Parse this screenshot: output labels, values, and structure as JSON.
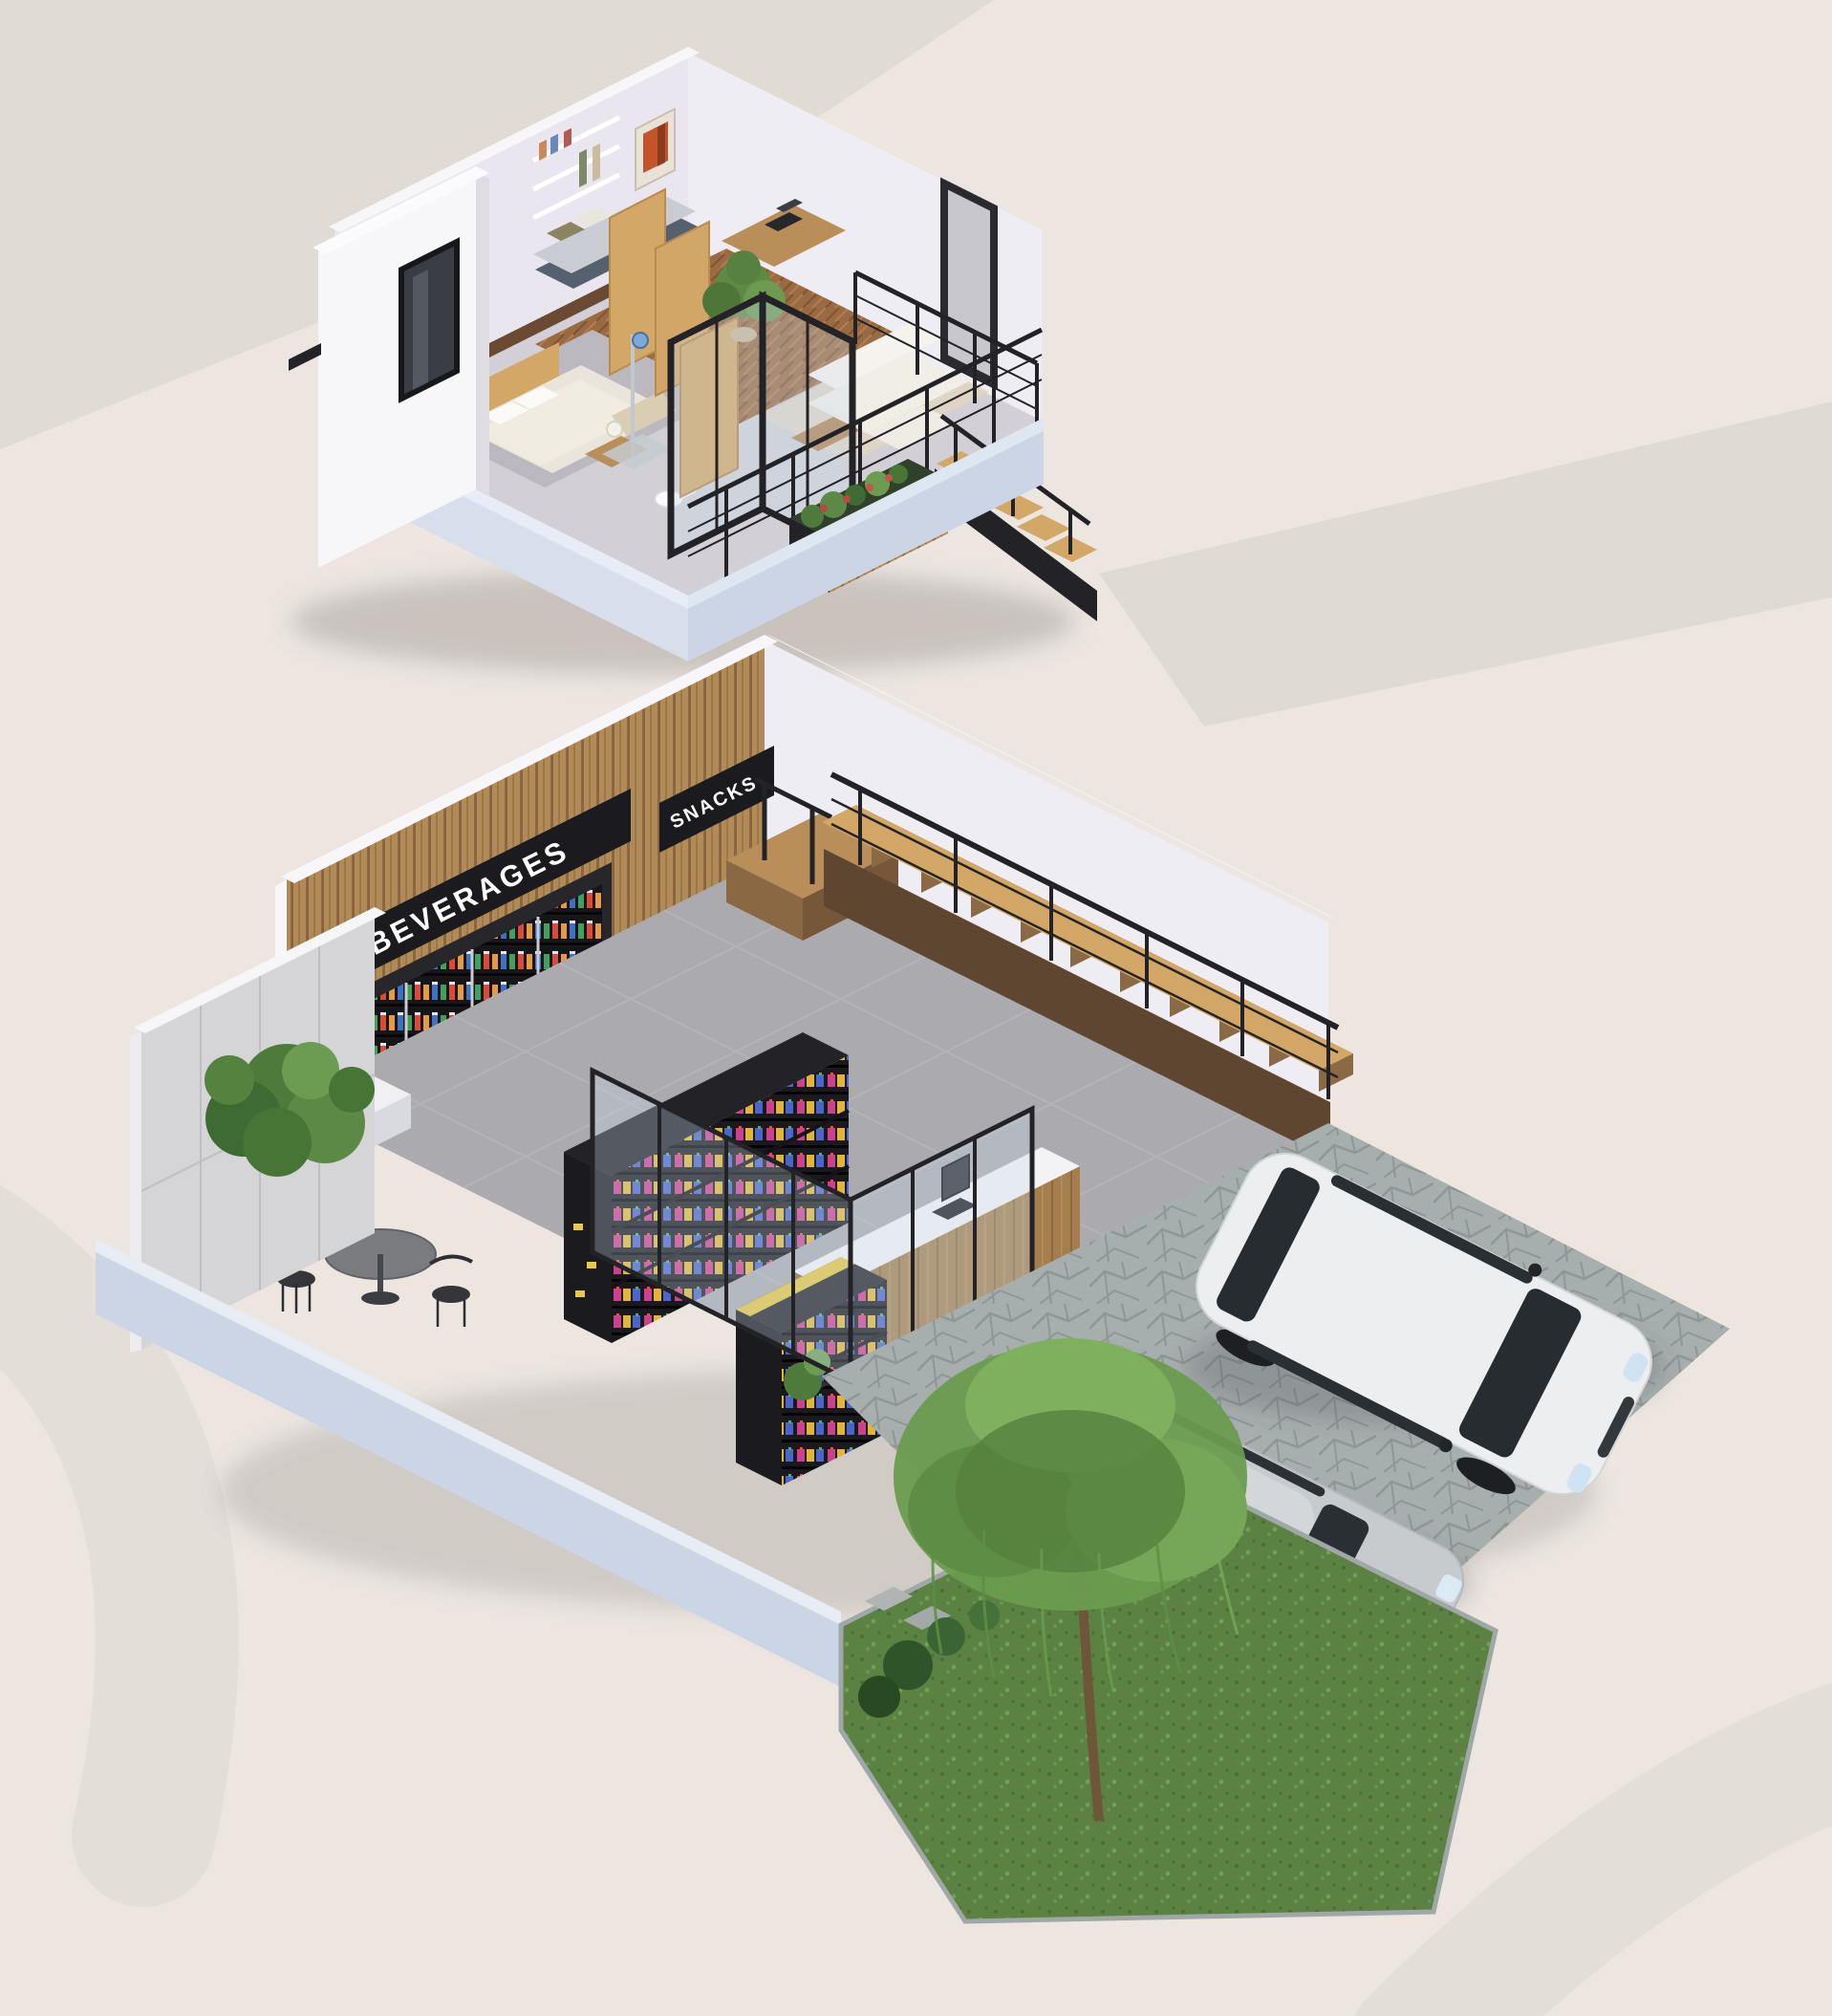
{
  "scene": {
    "description": "3D isometric cutaway of a two-storey minimart shophouse with parking",
    "ground_floor": {
      "signs": [
        {
          "label": "BEVERAGES"
        },
        {
          "label": "SNACKS"
        }
      ],
      "areas": [
        "minimart retail",
        "beverage cooler wall",
        "snack shelving",
        "cashier counter with pos",
        "cafe table seating",
        "staircase",
        "indoor planting bed",
        "glass storefront",
        "two-car parking",
        "garden lawn with willow tree"
      ]
    },
    "upper_floor": {
      "areas": [
        "bedroom with double bed",
        "daybed nook",
        "work desk",
        "bathroom with shower and toilet",
        "living room with white sofa",
        "balcony planter",
        "stairs down"
      ]
    }
  },
  "colors": {
    "bg": "#ECE5E0",
    "ribbon": "#DFD8D3",
    "wallWhite": "#F7F6F8",
    "wallLilac": "#E9E6EF",
    "wallLilacLight": "#EFEDF4",
    "plinth": "#CBD5E5",
    "plinthTop": "#E7ECF5",
    "metalBlack": "#232327",
    "signBg": "#1B1B1F",
    "signText": "#FFFFFF",
    "woodLight": "#D3A765",
    "woodMid": "#B98E59",
    "woodDark": "#5F4631",
    "slatWood": "#B18B57",
    "storeFloor": "#ABABAF",
    "lawn": "#5B8243",
    "treeCanopy": "#6A9B4F",
    "carWhite": "#ECEEF0",
    "carSilver": "#C8CBCE",
    "glassTint": "rgba(203,219,235,0.30)",
    "artOrange": "#C2552B",
    "stoneEdge": "#9FA8A6"
  }
}
